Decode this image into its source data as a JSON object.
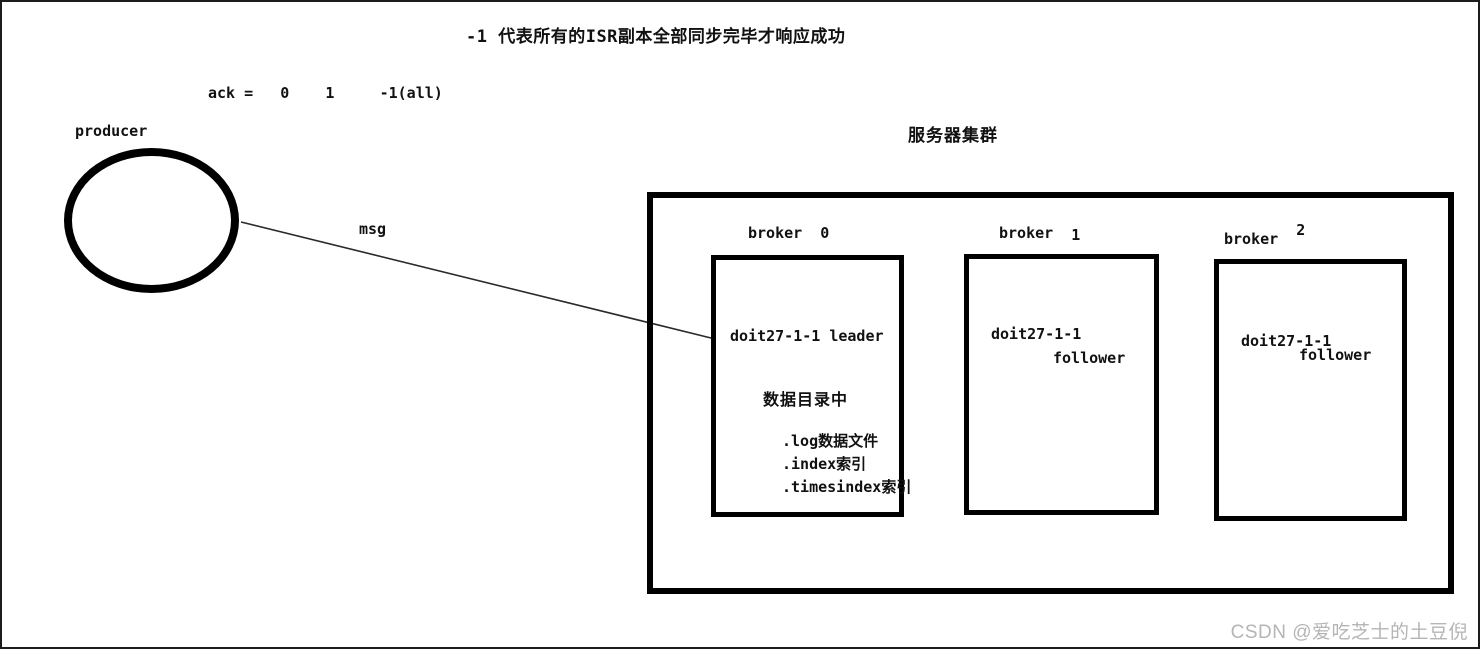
{
  "title": "-1 代表所有的ISR副本全部同步完毕才响应成功",
  "ack_line": "ack =   0    1     -1(all)",
  "producer": {
    "label": "producer"
  },
  "msg_label": "msg",
  "cluster": {
    "label": "服务器集群",
    "brokers": [
      {
        "name": "broker",
        "id": "0",
        "partition": "doit27-1-1",
        "role": "leader",
        "data_dir_title": "数据目录中",
        "files": [
          ".log数据文件",
          ".index索引",
          ".timesindex索引"
        ]
      },
      {
        "name": "broker",
        "id": "1",
        "partition": "doit27-1-1",
        "role": "follower"
      },
      {
        "name": "broker",
        "id": "2",
        "partition": "doit27-1-1",
        "role": "follower"
      }
    ]
  },
  "watermark": "CSDN @爱吃芝士的土豆倪",
  "colors": {
    "line": "#000000",
    "text": "#111111",
    "watermark": "#b5b5b5",
    "background": "#ffffff"
  }
}
